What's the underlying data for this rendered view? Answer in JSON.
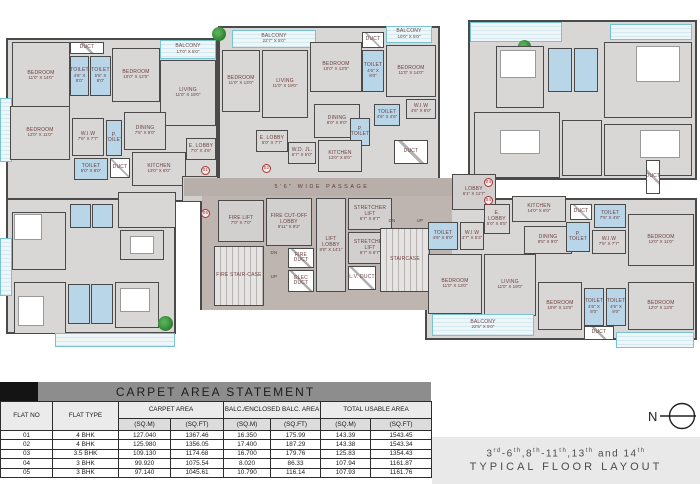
{
  "title_band": {
    "text": "CARPET AREA STATEMENT"
  },
  "table": {
    "columns": [
      "FLAT NO",
      "FLAT TYPE",
      "CARPET AREA",
      "BALC./ENCLOSED BALC. AREA",
      "TOTAL USABLE AREA"
    ],
    "subheaders": [
      "(SQ.M)",
      "(SQ.FT)",
      "(SQ.M)",
      "(SQ.FT)",
      "(SQ.M)",
      "(SQ.FT)"
    ],
    "rows": [
      [
        "01",
        "4 BHK",
        "127.040",
        "1367.46",
        "16.350",
        "175.99",
        "143.39",
        "1543.45"
      ],
      [
        "02",
        "4 BHK",
        "125.980",
        "1356.05",
        "17.400",
        "187.29",
        "143.38",
        "1543.34"
      ],
      [
        "03",
        "3.5 BHK",
        "109.130",
        "1174.68",
        "16.700",
        "179.76",
        "125.83",
        "1354.43"
      ],
      [
        "04",
        "3 BHK",
        "99.920",
        "1075.54",
        "8.020",
        "86.33",
        "107.94",
        "1161.87"
      ],
      [
        "05",
        "3 BHK",
        "97.140",
        "1045.61",
        "10.790",
        "116.14",
        "107.93",
        "1161.76"
      ]
    ]
  },
  "footer": {
    "line1_plain": "3rd-6th,8th-11th,13th and 14th",
    "line1_runs": [
      {
        "t": "3"
      },
      {
        "s": "rd"
      },
      {
        "t": "-6"
      },
      {
        "s": "th"
      },
      {
        "t": ",8"
      },
      {
        "s": "th"
      },
      {
        "t": "-11"
      },
      {
        "s": "th"
      },
      {
        "t": ",13"
      },
      {
        "s": "th"
      },
      {
        "t": " and 14"
      },
      {
        "s": "th"
      }
    ],
    "line2": "TYPICAL FLOOR LAYOUT"
  },
  "compass": {
    "label": "N"
  },
  "plan": {
    "passage_label": "5'6\" WIDE PASSAGE",
    "rooms": [
      {
        "t": "out",
        "x": 6,
        "y": 38,
        "w": 212,
        "h": 164
      },
      {
        "t": "out",
        "x": 6,
        "y": 198,
        "w": 170,
        "h": 136
      },
      {
        "t": "out",
        "x": 218,
        "y": 26,
        "w": 222,
        "h": 156
      },
      {
        "t": "out",
        "x": 200,
        "y": 178,
        "w": 260,
        "h": 132
      },
      {
        "t": "out",
        "x": 468,
        "y": 20,
        "w": 229,
        "h": 160
      },
      {
        "t": "out",
        "x": 425,
        "y": 198,
        "w": 272,
        "h": 142
      },
      {
        "t": "balcony",
        "x": 0,
        "y": 98,
        "w": 12,
        "h": 64
      },
      {
        "t": "room",
        "l": "BEDROOM",
        "d": "11'0\" X 14'0\"",
        "x": 12,
        "y": 42,
        "w": 58,
        "h": 68
      },
      {
        "t": "duct",
        "l": "DUCT",
        "x": 70,
        "y": 42,
        "w": 34,
        "h": 12
      },
      {
        "t": "toilet",
        "l": "TOILET",
        "d": "4'6\" X 8'0\"",
        "x": 70,
        "y": 56,
        "w": 19,
        "h": 40
      },
      {
        "t": "toilet",
        "l": "TOILET",
        "d": "5'6\" X 8'0\"",
        "x": 90,
        "y": 56,
        "w": 21,
        "h": 40
      },
      {
        "t": "room",
        "l": "BEDROOM",
        "d": "10'0\" X 12'0\"",
        "x": 112,
        "y": 48,
        "w": 48,
        "h": 54
      },
      {
        "t": "balcony",
        "l": "BALCONY",
        "d": "17'0\" X 5'0\"",
        "x": 160,
        "y": 40,
        "w": 56,
        "h": 19
      },
      {
        "t": "room",
        "l": "LIVING",
        "d": "11'0\" X 19'0\"",
        "x": 160,
        "y": 60,
        "w": 56,
        "h": 66
      },
      {
        "t": "room",
        "l": "BEDROOM",
        "d": "12'0\" X 11'0\"",
        "x": 10,
        "y": 106,
        "w": 60,
        "h": 54
      },
      {
        "t": "room",
        "l": "W.I.W",
        "d": "7'5\" X 7'7\"",
        "x": 72,
        "y": 118,
        "w": 32,
        "h": 38
      },
      {
        "t": "toilet",
        "l": "P. TOILET",
        "x": 106,
        "y": 120,
        "w": 16,
        "h": 36
      },
      {
        "t": "room",
        "l": "DINING",
        "d": "7'5\" X 9'0\"",
        "x": 124,
        "y": 112,
        "w": 42,
        "h": 38
      },
      {
        "t": "toilet",
        "l": "TOILET",
        "d": "5'0\" X 8'0\"",
        "x": 74,
        "y": 158,
        "w": 34,
        "h": 22
      },
      {
        "t": "duct",
        "l": "DUCT",
        "x": 110,
        "y": 158,
        "w": 20,
        "h": 20
      },
      {
        "t": "room",
        "l": "KITCHEN",
        "d": "13'0\" X 8'0\"",
        "x": 132,
        "y": 152,
        "w": 54,
        "h": 34
      },
      {
        "t": "room",
        "l": "E. LOBBY",
        "d": "7'0\" X 4'6\"",
        "x": 186,
        "y": 138,
        "w": 30,
        "h": 22
      },
      {
        "t": "core",
        "l": "LOBBY",
        "d": "9'0\" X 7'0\"",
        "x": 182,
        "y": 176,
        "w": 36,
        "h": 26
      },
      {
        "t": "room",
        "x": 118,
        "y": 192,
        "w": 58,
        "h": 36
      },
      {
        "t": "room",
        "x": 12,
        "y": 212,
        "w": 54,
        "h": 58
      },
      {
        "t": "furn",
        "x": 14,
        "y": 214,
        "w": 28,
        "h": 26
      },
      {
        "t": "toilet",
        "x": 70,
        "y": 204,
        "w": 21,
        "h": 24
      },
      {
        "t": "toilet",
        "x": 92,
        "y": 204,
        "w": 21,
        "h": 24
      },
      {
        "t": "room",
        "x": 120,
        "y": 230,
        "w": 44,
        "h": 30
      },
      {
        "t": "furn",
        "x": 130,
        "y": 236,
        "w": 24,
        "h": 18
      },
      {
        "t": "balcony",
        "x": 0,
        "y": 238,
        "w": 12,
        "h": 58
      },
      {
        "t": "room",
        "x": 14,
        "y": 282,
        "w": 52,
        "h": 52
      },
      {
        "t": "furn",
        "x": 18,
        "y": 296,
        "w": 26,
        "h": 30
      },
      {
        "t": "toilet",
        "x": 68,
        "y": 284,
        "w": 22,
        "h": 40
      },
      {
        "t": "toilet",
        "x": 91,
        "y": 284,
        "w": 22,
        "h": 40
      },
      {
        "t": "room",
        "x": 115,
        "y": 282,
        "w": 44,
        "h": 46
      },
      {
        "t": "furn",
        "x": 120,
        "y": 288,
        "w": 30,
        "h": 24
      },
      {
        "t": "balcony",
        "x": 55,
        "y": 333,
        "w": 120,
        "h": 14
      },
      {
        "t": "plant",
        "x": 158,
        "y": 316,
        "w": 15,
        "h": 15
      },
      {
        "t": "balcony",
        "l": "BALCONY",
        "d": "22'7\" X 5'0\"",
        "x": 232,
        "y": 30,
        "w": 84,
        "h": 18
      },
      {
        "t": "room",
        "l": "BEDROOM",
        "d": "11'0\" X 13'0\"",
        "x": 222,
        "y": 50,
        "w": 38,
        "h": 62
      },
      {
        "t": "room",
        "l": "LIVING",
        "d": "11'0\" X 19'0\"",
        "x": 262,
        "y": 50,
        "w": 46,
        "h": 68
      },
      {
        "t": "room",
        "l": "BEDROOM",
        "d": "10'0\" X 13'0\"",
        "x": 310,
        "y": 42,
        "w": 52,
        "h": 50
      },
      {
        "t": "duct",
        "l": "DUCT",
        "x": 362,
        "y": 32,
        "w": 22,
        "h": 16
      },
      {
        "t": "toilet",
        "l": "TOILET",
        "d": "4'6\" X 8'0\"",
        "x": 362,
        "y": 50,
        "w": 22,
        "h": 42
      },
      {
        "t": "balcony",
        "l": "BALCONY",
        "d": "10'0\" X 5'0\"",
        "x": 386,
        "y": 26,
        "w": 46,
        "h": 17
      },
      {
        "t": "room",
        "l": "BEDROOM",
        "d": "11'0\" X 14'0\"",
        "x": 386,
        "y": 45,
        "w": 50,
        "h": 52
      },
      {
        "t": "room",
        "l": "W.I.W",
        "d": "4'6\" X 8'0\"",
        "x": 406,
        "y": 99,
        "w": 30,
        "h": 20
      },
      {
        "t": "room",
        "l": "DINING",
        "d": "8'0\" X 9'0\"",
        "x": 314,
        "y": 104,
        "w": 46,
        "h": 34
      },
      {
        "t": "toilet",
        "l": "TOILET",
        "d": "4'6\" X 4'6\"",
        "x": 374,
        "y": 104,
        "w": 26,
        "h": 22
      },
      {
        "t": "toilet",
        "l": "P. TOILET",
        "x": 350,
        "y": 118,
        "w": 20,
        "h": 28
      },
      {
        "t": "room",
        "l": "E. LOBBY",
        "d": "5'0\" X 7'7\"",
        "x": 256,
        "y": 130,
        "w": 32,
        "h": 22
      },
      {
        "t": "room",
        "l": "W.D. JL.",
        "d": "5'7\" X 5'0\"",
        "x": 288,
        "y": 142,
        "w": 28,
        "h": 22
      },
      {
        "t": "room",
        "l": "KITCHEN",
        "d": "13'0\" X 8'0\"",
        "x": 318,
        "y": 140,
        "w": 44,
        "h": 32
      },
      {
        "t": "duct",
        "l": "DUCT",
        "x": 394,
        "y": 140,
        "w": 34,
        "h": 24
      },
      {
        "t": "plant",
        "x": 212,
        "y": 27,
        "w": 14,
        "h": 14
      },
      {
        "t": "balcony",
        "x": 470,
        "y": 22,
        "w": 92,
        "h": 20
      },
      {
        "t": "plant",
        "x": 518,
        "y": 40,
        "w": 13,
        "h": 13
      },
      {
        "t": "room",
        "x": 496,
        "y": 46,
        "w": 48,
        "h": 62
      },
      {
        "t": "furn",
        "x": 500,
        "y": 50,
        "w": 36,
        "h": 28
      },
      {
        "t": "toilet",
        "x": 548,
        "y": 48,
        "w": 24,
        "h": 44
      },
      {
        "t": "toilet",
        "x": 574,
        "y": 48,
        "w": 24,
        "h": 44
      },
      {
        "t": "balcony",
        "x": 610,
        "y": 24,
        "w": 82,
        "h": 16
      },
      {
        "t": "room",
        "x": 604,
        "y": 42,
        "w": 88,
        "h": 76
      },
      {
        "t": "furn",
        "x": 636,
        "y": 46,
        "w": 44,
        "h": 36
      },
      {
        "t": "room",
        "x": 474,
        "y": 112,
        "w": 86,
        "h": 66
      },
      {
        "t": "furn",
        "x": 500,
        "y": 130,
        "w": 40,
        "h": 24
      },
      {
        "t": "room",
        "x": 562,
        "y": 120,
        "w": 40,
        "h": 56
      },
      {
        "t": "room",
        "x": 604,
        "y": 124,
        "w": 88,
        "h": 52
      },
      {
        "t": "furn",
        "x": 640,
        "y": 130,
        "w": 40,
        "h": 28
      },
      {
        "t": "duct",
        "l": "DUCT",
        "x": 646,
        "y": 160,
        "w": 14,
        "h": 34
      },
      {
        "t": "corefloor",
        "x": 202,
        "y": 196,
        "w": 250,
        "h": 114
      },
      {
        "t": "passage",
        "l": "5'6\" WIDE PASSAGE",
        "x": 184,
        "y": 178,
        "w": 276,
        "h": 18,
        "n": "passage"
      },
      {
        "t": "core",
        "l": "FIRE LIFT",
        "d": "7'0\" X 7'0\"",
        "x": 218,
        "y": 200,
        "w": 46,
        "h": 42
      },
      {
        "t": "core",
        "l": "FIRE CUT-OFF LOBBY",
        "d": "9'11\" X 8'2\"",
        "x": 266,
        "y": 198,
        "w": 46,
        "h": 48
      },
      {
        "t": "stair",
        "l": "FIRE STAIR-CASE",
        "x": 214,
        "y": 246,
        "w": 50,
        "h": 60
      },
      {
        "t": "txt",
        "l": "DN",
        "x": 266,
        "y": 248,
        "w": 16,
        "h": 10
      },
      {
        "t": "txt",
        "l": "UP",
        "x": 266,
        "y": 272,
        "w": 16,
        "h": 10
      },
      {
        "t": "duct",
        "l": "FIRE DUCT",
        "x": 288,
        "y": 248,
        "w": 26,
        "h": 20
      },
      {
        "t": "duct",
        "l": "ELEC DUCT",
        "x": 288,
        "y": 270,
        "w": 26,
        "h": 22
      },
      {
        "t": "core",
        "l": "LIFT LOBBY",
        "d": "8'0\" X 14'1\"",
        "x": 316,
        "y": 198,
        "w": 30,
        "h": 94
      },
      {
        "t": "core",
        "l": "STRETCHER LIFT",
        "d": "6'7\" X 6'7\"",
        "x": 348,
        "y": 198,
        "w": 44,
        "h": 32
      },
      {
        "t": "core",
        "l": "STRETCHER LIFT",
        "d": "6'7\" X 6'7\"",
        "x": 348,
        "y": 232,
        "w": 44,
        "h": 32
      },
      {
        "t": "duct",
        "l": "L.V. DUCT",
        "x": 348,
        "y": 266,
        "w": 28,
        "h": 24
      },
      {
        "t": "stair",
        "l": "STAIRCASE",
        "x": 380,
        "y": 228,
        "w": 50,
        "h": 64
      },
      {
        "t": "txt",
        "l": "DN",
        "x": 384,
        "y": 216,
        "w": 16,
        "h": 10
      },
      {
        "t": "txt",
        "l": "UP",
        "x": 412,
        "y": 216,
        "w": 16,
        "h": 10
      },
      {
        "t": "core",
        "l": "LOBBY",
        "d": "6'1\" X 11'7\"",
        "x": 452,
        "y": 174,
        "w": 44,
        "h": 36
      },
      {
        "t": "toilet",
        "l": "TOILET",
        "d": "4'6\" X 8'0\"",
        "x": 428,
        "y": 222,
        "w": 30,
        "h": 28
      },
      {
        "t": "room",
        "l": "W.I.W",
        "d": "4'7\" X 5'3\"",
        "x": 460,
        "y": 222,
        "w": 24,
        "h": 28
      },
      {
        "t": "room",
        "l": "E. LOBBY",
        "d": "5'0\" X 8'5\"",
        "x": 484,
        "y": 204,
        "w": 26,
        "h": 30
      },
      {
        "t": "room",
        "l": "KITCHEN",
        "d": "14'0\" X 8'0\"",
        "x": 512,
        "y": 196,
        "w": 54,
        "h": 26
      },
      {
        "t": "room",
        "l": "DINING",
        "d": "8'5\" X 9'0\"",
        "x": 524,
        "y": 226,
        "w": 48,
        "h": 28
      },
      {
        "t": "duct",
        "l": "DUCT",
        "x": 570,
        "y": 204,
        "w": 22,
        "h": 16
      },
      {
        "t": "toilet",
        "l": "TOILET",
        "d": "7'5\" X 4'6\"",
        "x": 594,
        "y": 204,
        "w": 32,
        "h": 24
      },
      {
        "t": "toilet",
        "l": "P. TOILET",
        "x": 566,
        "y": 222,
        "w": 24,
        "h": 30
      },
      {
        "t": "room",
        "l": "W.I.W",
        "d": "7'5\" X 7'7\"",
        "x": 592,
        "y": 230,
        "w": 34,
        "h": 24
      },
      {
        "t": "room",
        "l": "BEDROOM",
        "d": "12'0\" X 11'0\"",
        "x": 628,
        "y": 214,
        "w": 66,
        "h": 52
      },
      {
        "t": "room",
        "l": "BEDROOM",
        "d": "11'0\" X 13'0\"",
        "x": 428,
        "y": 254,
        "w": 54,
        "h": 60
      },
      {
        "t": "room",
        "l": "LIVING",
        "d": "11'0\" X 19'0\"",
        "x": 484,
        "y": 254,
        "w": 52,
        "h": 62
      },
      {
        "t": "room",
        "l": "BEDROOM",
        "d": "10'9\" X 13'0\"",
        "x": 538,
        "y": 282,
        "w": 44,
        "h": 48
      },
      {
        "t": "toilet",
        "l": "TOILET",
        "d": "4'6\" X 8'0\"",
        "x": 584,
        "y": 288,
        "w": 20,
        "h": 38
      },
      {
        "t": "toilet",
        "l": "TOILET",
        "d": "4'6\" X 8'0\"",
        "x": 606,
        "y": 288,
        "w": 20,
        "h": 38
      },
      {
        "t": "room",
        "l": "BEDROOM",
        "d": "12'0\" X 13'0\"",
        "x": 628,
        "y": 282,
        "w": 66,
        "h": 48
      },
      {
        "t": "balcony",
        "l": "BALCONY",
        "d": "22'5\" X 5'0\"",
        "x": 432,
        "y": 314,
        "w": 102,
        "h": 22
      },
      {
        "t": "duct",
        "l": "DUCT",
        "x": 584,
        "y": 326,
        "w": 30,
        "h": 14
      },
      {
        "t": "balcony",
        "x": 616,
        "y": 332,
        "w": 78,
        "h": 16
      }
    ],
    "markers": [
      {
        "l": "01",
        "x": 201,
        "y": 166
      },
      {
        "l": "02",
        "x": 262,
        "y": 164
      },
      {
        "l": "03",
        "x": 484,
        "y": 178
      },
      {
        "l": "04",
        "x": 484,
        "y": 196
      },
      {
        "l": "05",
        "x": 201,
        "y": 209
      }
    ]
  }
}
